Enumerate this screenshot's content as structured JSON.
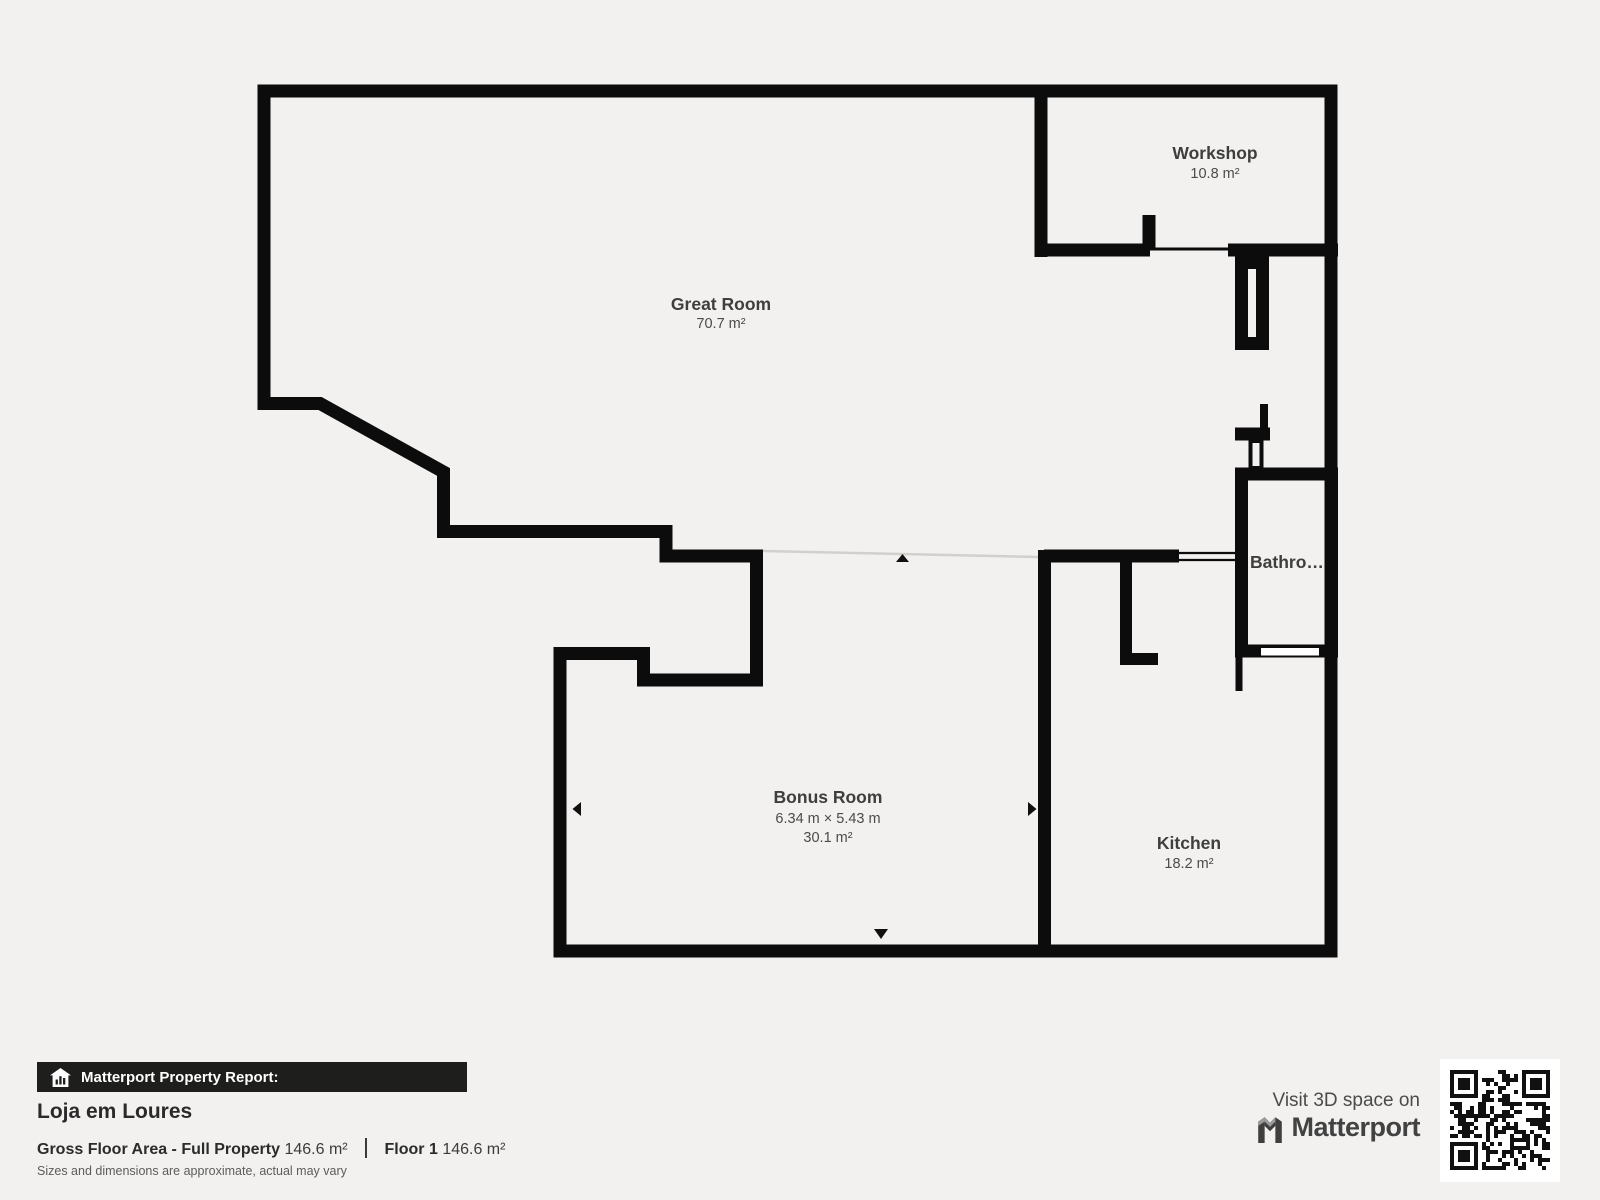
{
  "floorplan": {
    "rooms": {
      "great_room": {
        "name": "Great Room",
        "area": "70.7 m²"
      },
      "workshop": {
        "name": "Workshop",
        "area": "10.8 m²"
      },
      "bathroom": {
        "name": "Bathro…"
      },
      "bonus_room": {
        "name": "Bonus Room",
        "dimensions": "6.34 m × 5.43 m",
        "area": "30.1 m²"
      },
      "kitchen": {
        "name": "Kitchen",
        "area": "18.2 m²"
      }
    }
  },
  "report": {
    "bar_label": "Matterport Property Report:",
    "property_name": "Loja em Loures",
    "gross_label": "Gross Floor Area - Full Property",
    "gross_value": "146.6 m²",
    "floor_label": "Floor 1",
    "floor_value": "146.6 m²",
    "disclaimer": "Sizes and dimensions are approximate, actual may vary"
  },
  "branding": {
    "visit_text": "Visit 3D space on",
    "logo_text": "Matterport"
  },
  "colors": {
    "background": "#f2f1ef",
    "wall": "#0c0c0c",
    "room_fill": "#ffffff",
    "label_text": "#3e3e3e",
    "report_bar_bg": "#1e1e1c"
  }
}
